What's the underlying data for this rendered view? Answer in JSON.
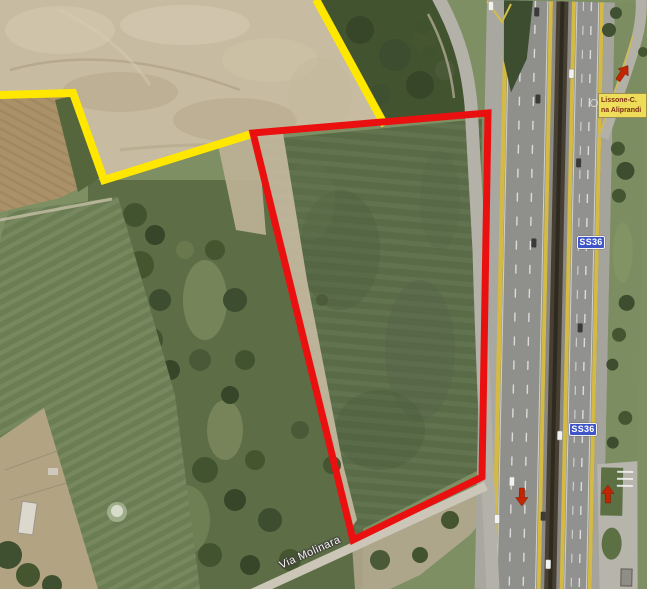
{
  "map": {
    "badges": {
      "ss36_upper": "SS36",
      "ss36_lower": "SS36"
    },
    "exit_label": {
      "line1": "Lissone-C.",
      "line2": "na Aliprandi"
    },
    "street_label": "Via Molinara"
  },
  "colors": {
    "annotation_red": "#ea1010",
    "annotation_yellow": "#ffe700",
    "arrow_red": "#c32500",
    "badge_blue": "#3e55c8",
    "badge_text": "#ffffff",
    "exit_bg": "#f2e157",
    "exit_border": "#9a8f50",
    "exit_text": "#7c2810",
    "street_text": "#f7f5ef"
  }
}
